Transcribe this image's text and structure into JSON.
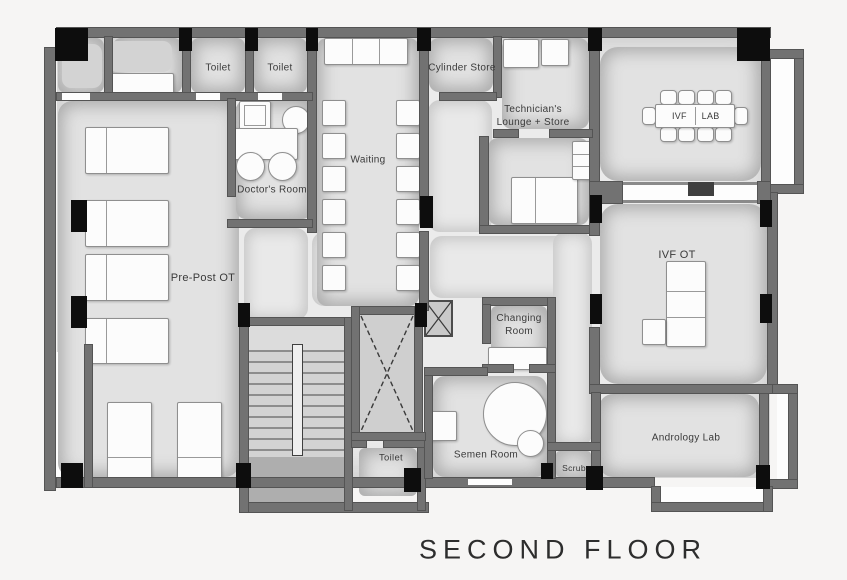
{
  "title": "SECOND FLOOR",
  "colors": {
    "background": "#f6f5f4",
    "wall": "#727272",
    "column": "#0d0d0d",
    "room_floor": "#e2e2e2",
    "furniture": "#fcfcfc"
  },
  "rooms": {
    "toilet_top_left": {
      "label": "Toilet"
    },
    "toilet_top_right": {
      "label": "Toilet"
    },
    "doctors_room": {
      "label": "Doctor's Room"
    },
    "waiting": {
      "label": "Waiting"
    },
    "cylinder_store": {
      "label": "Cylinder Store"
    },
    "technicians_lounge": {
      "label": "Technician's Lounge + Store"
    },
    "ivf_lab": {
      "label_left": "IVF",
      "label_right": "LAB"
    },
    "pre_post_ot": {
      "label": "Pre-Post OT"
    },
    "ivf_ot": {
      "label": "IVF OT"
    },
    "changing_room": {
      "label": "Changing Room"
    },
    "semen_room": {
      "label": "Semen Room"
    },
    "scrub": {
      "label": "Scrub"
    },
    "toilet_bottom": {
      "label": "Toilet"
    },
    "andrology_lab": {
      "label": "Andrology Lab"
    }
  }
}
